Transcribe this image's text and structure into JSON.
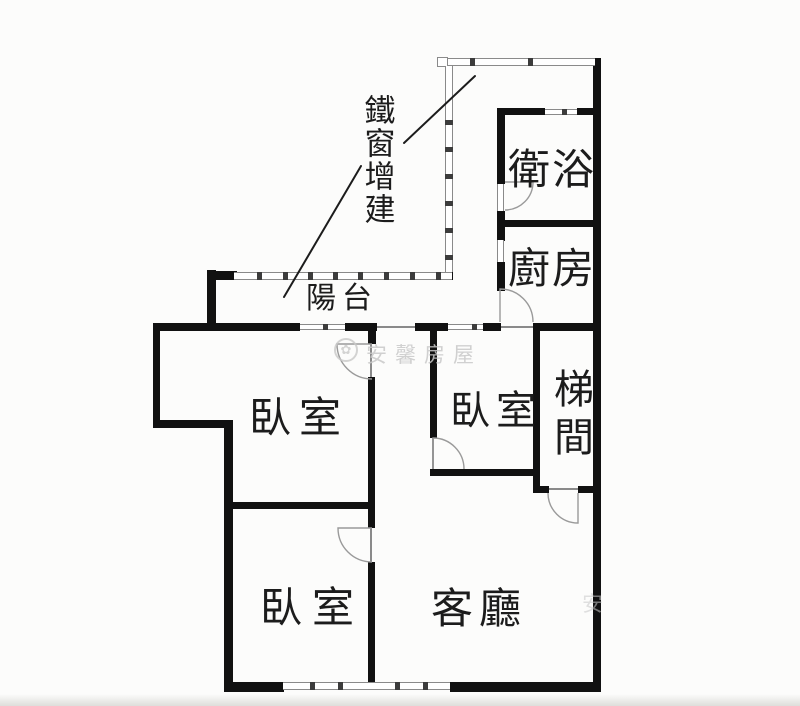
{
  "document": {
    "type": "apartment-floor-plan",
    "language": "zh-TW"
  },
  "annotation": {
    "iron_window_label": "鐵窗增建"
  },
  "rooms": {
    "balcony": {
      "label": "陽台"
    },
    "bathroom": {
      "label": "衛浴"
    },
    "kitchen": {
      "label": "廚房"
    },
    "bedroom_upper": {
      "label": "臥室"
    },
    "bedroom_middle": {
      "label": "臥室"
    },
    "bedroom_lower": {
      "label": "臥室"
    },
    "stairwell": {
      "label": "梯間"
    },
    "living_room": {
      "label": "客廳"
    }
  },
  "watermark": {
    "text": "安馨房屋",
    "fragment": "安",
    "logo": "flower-seal-icon"
  },
  "colors": {
    "wall": "#111111",
    "line": "#8a8a8a",
    "arc": "#9a9a9a",
    "ink": "#1c1c1c",
    "wm": "#c9c9c9",
    "bg": "#fcfcfb"
  }
}
